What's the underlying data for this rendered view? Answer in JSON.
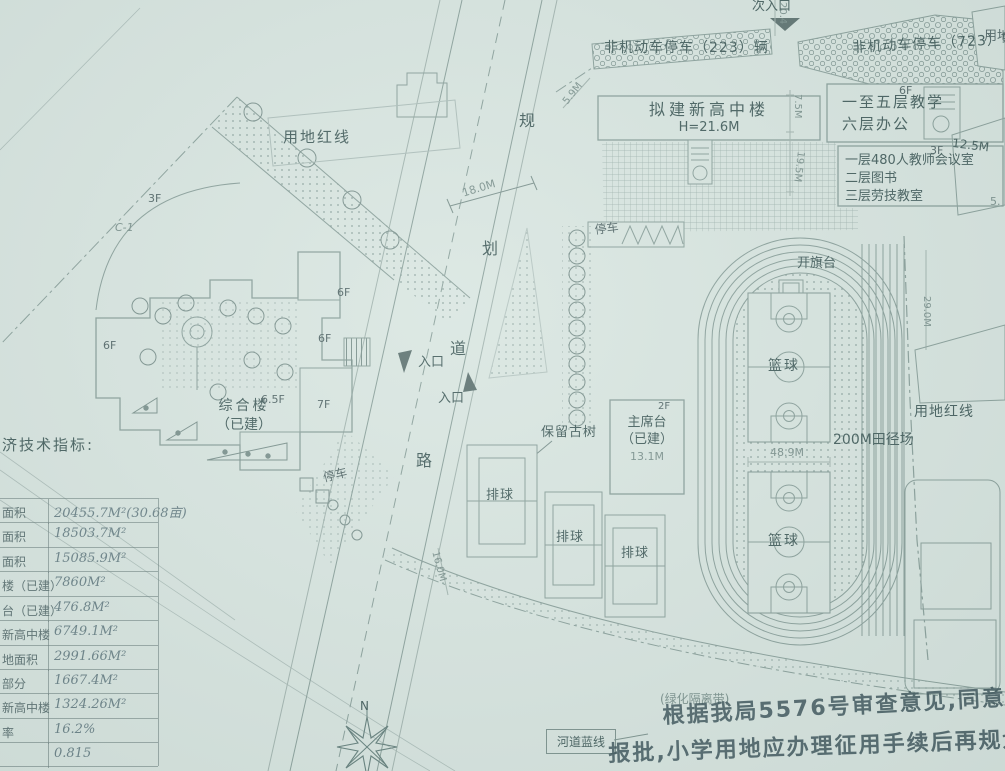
{
  "colors": {
    "paper": "#d9e6e1",
    "linework": "#8ba19c",
    "ink": "#55696a",
    "handwriting": "#3c545a"
  },
  "top": {
    "secondary_entrance": "次入口",
    "dim_20_4": "20.4",
    "bike_parking_left": "非机动车停车（223）辆",
    "bike_parking_right": "非机动车停车（723）辆",
    "red_line_corner": "用地"
  },
  "left_parcel": {
    "red_line": "用地红线",
    "floor_3f": "3F",
    "code_c1": "C-1",
    "floor_6f_a": "6F",
    "floor_6f_b": "6F",
    "floor_6f_c": "6F",
    "floor_6_5f": "6.5F",
    "floor_7f": "7F",
    "complex_name": "综合楼",
    "complex_status": "（已建）",
    "parking": "停车"
  },
  "road": {
    "char_1": "规",
    "char_2": "划",
    "char_3": "道",
    "char_4": "路",
    "dim_width": "18.0M",
    "dim_lower": "16.0M",
    "entrance_1": "入口",
    "entrance_2": "入口"
  },
  "campus": {
    "new_building": "拟建新高中楼",
    "new_building_height": "H=21.6M",
    "block_6f": "6F",
    "teach_floors": "一至五层教学",
    "office_floor": "六层办公",
    "block_3f": "3F",
    "annex_line1": "一层480人教师会议室",
    "annex_line2": "二层图书",
    "annex_line3": "三层劳技教室",
    "dim_5_9": "5.9M",
    "dim_7_5": "7.5M",
    "dim_19_5": "19.5M",
    "dim_12_5": "12.5M",
    "dim_5": "5.",
    "dim_29": "29.0M",
    "parking_top": "停车",
    "old_tree": "保留古树",
    "stage": "主席台",
    "stage_status": "（已建）",
    "stage_floor": "2F",
    "stage_dim": "13.1M",
    "flag_stand": "开旗台",
    "basketball_1": "篮球",
    "basketball_2": "篮球",
    "volleyball_1": "排球",
    "volleyball_2": "排球",
    "volleyball_3": "排球",
    "track": "200M田径场",
    "track_dim": "48.9M",
    "red_line_right": "用地红线",
    "green_belt": "(绿化隔离带)"
  },
  "bottom": {
    "north": "N",
    "river_line": "河道蓝线",
    "note_line1": "根据我局5576号审查意见,同意本规划",
    "note_line2": "报批,小学用地应办理征用手续后再规划"
  },
  "table": {
    "title": "济技术指标:",
    "rows": [
      {
        "label": "面积",
        "value": "20455.7M²(30.68亩)"
      },
      {
        "label": "面积",
        "value": "18503.7M²"
      },
      {
        "label": "面积",
        "value": "15085.9M²"
      },
      {
        "label": "楼（已建）",
        "value": "7860M²"
      },
      {
        "label": "台（已建）",
        "value": "476.8M²"
      },
      {
        "label": "新高中楼",
        "value": "6749.1M²"
      },
      {
        "label": "地面积",
        "value": "2991.66M²"
      },
      {
        "label": "部分",
        "value": "1667.4M²"
      },
      {
        "label": "新高中楼",
        "value": "1324.26M²"
      },
      {
        "label": "率",
        "value": "16.2%"
      },
      {
        "label": "",
        "value": "0.815"
      }
    ]
  }
}
